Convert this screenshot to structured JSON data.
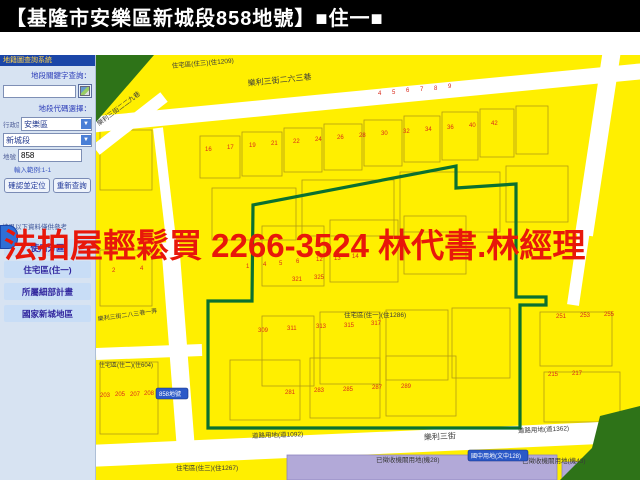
{
  "title": {
    "text": "【基隆市安樂區新城段858地號】■住一■"
  },
  "banner": {
    "text": "法拍屋輕鬆買  2266-3524  林代書.林經理",
    "color": "#e8170a"
  },
  "sidebar": {
    "header": "地籍圖查詢系統",
    "keyword_label": "地段關鍵字查詢：",
    "keyword_value": "",
    "code_select_label": "地段代碼選擇：",
    "district_label": "行政區",
    "district_value": "安樂區",
    "section_value": "新城段",
    "lot_label": "地號",
    "lot_value": "858",
    "hint": "輸入範例:1-1",
    "locate_button": "確認並定位",
    "requery_button": "重新查詢",
    "note": "結果以下資料僅供參考",
    "result_items": [
      "使用分區",
      "住宅區(住一)",
      "所屬細部計畫",
      "國家新城地區"
    ]
  },
  "map": {
    "colors": {
      "parcel_yellow": "#ffef00",
      "road_white": "#ffffff",
      "zone_green": "#2e7318",
      "boundary_green": "#0b7030",
      "purple": "#b2a9d8",
      "number_red": "#d92b1b",
      "label_dark": "#3a3a3a"
    },
    "roads": [
      {
        "pts": "88,125 645,71",
        "w": 16
      },
      {
        "pts": "96,150 164,97",
        "w": 12
      },
      {
        "pts": "158,128 172,248",
        "w": 10
      },
      {
        "pts": "170,242 186,450",
        "w": 18
      },
      {
        "pts": "88,456 645,431",
        "w": 22
      },
      {
        "pts": "612,50 584,235",
        "w": 18
      },
      {
        "pts": "584,230 573,305",
        "w": 12
      },
      {
        "pts": "96,354 202,350",
        "w": 12
      },
      {
        "pts": "588,480 606,438",
        "w": 9
      }
    ],
    "zones": [
      {
        "pts": "96,55 154,55 96,122"
      },
      {
        "pts": "600,416 640,406 640,480 560,480 592,448"
      }
    ],
    "purple_areas": [
      {
        "x": 287,
        "y": 455,
        "w": 270,
        "h": 25
      },
      {
        "x": 562,
        "y": 462,
        "w": 26,
        "h": 18
      }
    ],
    "boundary": "253,205 456,166 456,188 516,184 516,297 546,297 546,305 520,305 520,428 208,428 208,301 252,301",
    "parcels": [
      [
        200,
        136,
        40,
        42
      ],
      [
        242,
        132,
        40,
        44
      ],
      [
        284,
        128,
        38,
        44
      ],
      [
        324,
        124,
        38,
        46
      ],
      [
        364,
        120,
        38,
        46
      ],
      [
        404,
        116,
        36,
        46
      ],
      [
        442,
        112,
        36,
        48
      ],
      [
        480,
        109,
        34,
        48
      ],
      [
        516,
        106,
        32,
        48
      ],
      [
        212,
        188,
        84,
        52
      ],
      [
        302,
        180,
        92,
        56
      ],
      [
        400,
        172,
        100,
        60
      ],
      [
        506,
        166,
        62,
        56
      ],
      [
        262,
        226,
        62,
        60
      ],
      [
        330,
        220,
        68,
        62
      ],
      [
        404,
        216,
        62,
        58
      ],
      [
        262,
        316,
        52,
        70
      ],
      [
        320,
        312,
        60,
        72
      ],
      [
        386,
        310,
        62,
        70
      ],
      [
        452,
        308,
        58,
        70
      ],
      [
        540,
        312,
        72,
        54
      ],
      [
        544,
        372,
        76,
        50
      ],
      [
        100,
        362,
        58,
        72
      ],
      [
        230,
        360,
        70,
        60
      ],
      [
        310,
        358,
        70,
        60
      ],
      [
        386,
        356,
        70,
        60
      ],
      [
        100,
        250,
        52,
        56
      ],
      [
        100,
        130,
        52,
        60
      ]
    ],
    "labels": [
      {
        "t": "住宅區(住三)(住1209)",
        "x": 172,
        "y": 68,
        "s": 6.5,
        "r": -5
      },
      {
        "t": "樂利三街二六三巷",
        "x": 248,
        "y": 86,
        "s": 8,
        "r": -6
      },
      {
        "t": "樂利三街二二九巷",
        "x": 99,
        "y": 126,
        "s": 6.5,
        "r": -37
      },
      {
        "t": "樂利三街二八三巷一弄",
        "x": 98,
        "y": 321,
        "s": 6,
        "r": -8
      },
      {
        "t": "住宅區(住一)(住1286)",
        "x": 344,
        "y": 317,
        "s": 6.5,
        "r": 0
      },
      {
        "t": "住宅區(住二)(住604)",
        "x": 99,
        "y": 367,
        "s": 6,
        "r": 0
      },
      {
        "t": "樂利三街",
        "x": 424,
        "y": 440,
        "s": 8,
        "r": -3
      },
      {
        "t": "道路用地(道1092)",
        "x": 252,
        "y": 438,
        "s": 6.5,
        "r": -2
      },
      {
        "t": "道路用地(道1362)",
        "x": 518,
        "y": 433,
        "s": 6.5,
        "r": -3
      },
      {
        "t": "住宅區(住三)(住1267)",
        "x": 176,
        "y": 470,
        "s": 6.5,
        "r": 0
      },
      {
        "t": "已徵收機關用地(機28)",
        "x": 376,
        "y": 462,
        "s": 6.5,
        "r": 0
      },
      {
        "t": "已徵收機關用地(機43)",
        "x": 522,
        "y": 463,
        "s": 6.5,
        "r": 0
      }
    ],
    "numbers": [
      [
        "16",
        205,
        151
      ],
      [
        "17",
        227,
        149
      ],
      [
        "19",
        249,
        147
      ],
      [
        "21",
        271,
        145
      ],
      [
        "22",
        293,
        143
      ],
      [
        "24",
        315,
        141
      ],
      [
        "26",
        337,
        139
      ],
      [
        "28",
        359,
        137
      ],
      [
        "30",
        381,
        135
      ],
      [
        "32",
        403,
        133
      ],
      [
        "34",
        425,
        131
      ],
      [
        "36",
        447,
        129
      ],
      [
        "40",
        469,
        127
      ],
      [
        "42",
        491,
        125
      ],
      [
        "4",
        378,
        95
      ],
      [
        "5",
        392,
        94
      ],
      [
        "6",
        406,
        92
      ],
      [
        "7",
        420,
        91
      ],
      [
        "8",
        434,
        90
      ],
      [
        "9",
        448,
        88
      ],
      [
        "1",
        246,
        268
      ],
      [
        "4",
        263,
        266
      ],
      [
        "5",
        279,
        265
      ],
      [
        "6",
        296,
        263
      ],
      [
        "12",
        316,
        261
      ],
      [
        "13",
        334,
        260
      ],
      [
        "14",
        352,
        258
      ],
      [
        "321",
        292,
        281
      ],
      [
        "325",
        314,
        279
      ],
      [
        "309",
        258,
        332
      ],
      [
        "311",
        287,
        330
      ],
      [
        "313",
        316,
        328
      ],
      [
        "315",
        344,
        327
      ],
      [
        "317",
        371,
        325
      ],
      [
        "281",
        285,
        394
      ],
      [
        "283",
        314,
        392
      ],
      [
        "285",
        343,
        391
      ],
      [
        "287",
        372,
        389
      ],
      [
        "289",
        401,
        388
      ],
      [
        "203",
        100,
        397
      ],
      [
        "205",
        115,
        396
      ],
      [
        "207",
        130,
        396
      ],
      [
        "208",
        144,
        395
      ],
      [
        "209",
        158,
        395
      ],
      [
        "2",
        112,
        272
      ],
      [
        "4",
        140,
        270
      ],
      [
        "251",
        556,
        318
      ],
      [
        "253",
        580,
        317
      ],
      [
        "255",
        604,
        316
      ],
      [
        "215",
        548,
        376
      ],
      [
        "217",
        572,
        375
      ]
    ],
    "badges": [
      {
        "text": "858地號",
        "x": 156,
        "y": 388,
        "w": 32,
        "h": 11
      },
      {
        "text": "國中用地(文中128)",
        "x": 468,
        "y": 450,
        "w": 60,
        "h": 11
      }
    ]
  }
}
